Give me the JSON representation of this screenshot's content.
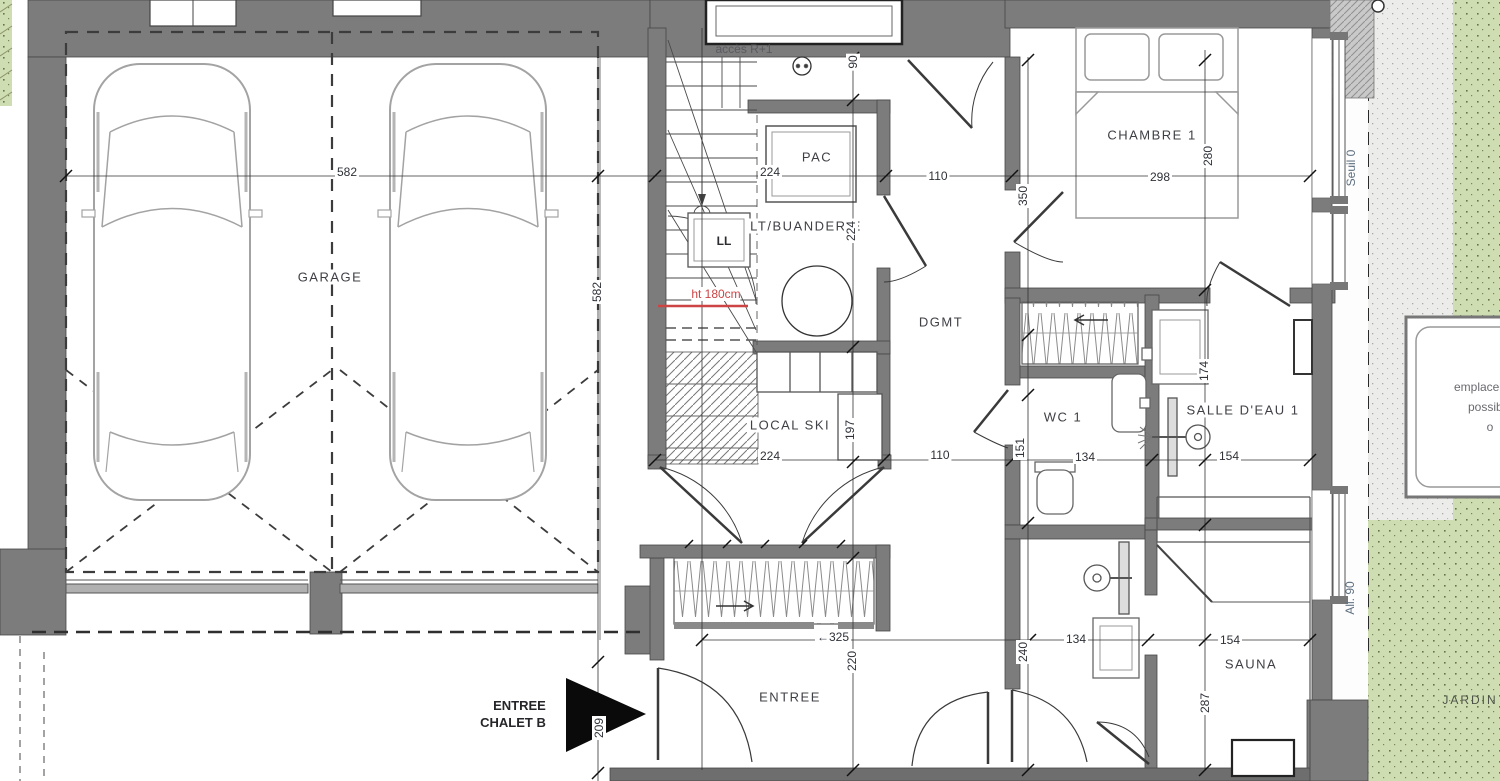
{
  "colors": {
    "wall": "#7c7c7c",
    "wall_dark": "#474747",
    "garden_green": "#cfddb2",
    "terrace_grey": "#ececea",
    "accent_red": "#cc4444",
    "dim_text": "#2e3138",
    "note_blue_grey": "#5f7080"
  },
  "rooms": [
    {
      "id": "garage",
      "label": "GARAGE",
      "x": 330,
      "y": 277
    },
    {
      "id": "pac",
      "label": "PAC",
      "x": 817,
      "y": 157
    },
    {
      "id": "buanderie",
      "label": "LT/BUANDERIE",
      "x": 806,
      "y": 226
    },
    {
      "id": "local-ski",
      "label": "LOCAL SKI",
      "x": 790,
      "y": 425
    },
    {
      "id": "dgmt",
      "label": "DGMT",
      "x": 941,
      "y": 322
    },
    {
      "id": "chambre-1",
      "label": "CHAMBRE 1",
      "x": 1152,
      "y": 135
    },
    {
      "id": "wc-1",
      "label": "WC 1",
      "x": 1063,
      "y": 417
    },
    {
      "id": "salle-deau-1",
      "label": "SALLE D'EAU 1",
      "x": 1243,
      "y": 410
    },
    {
      "id": "sauna",
      "label": "SAUNA",
      "x": 1251,
      "y": 664
    },
    {
      "id": "entree",
      "label": "ENTREE",
      "x": 790,
      "y": 697
    }
  ],
  "dimensions": [
    {
      "v": "582",
      "x": 347,
      "y": 172
    },
    {
      "v": "582",
      "x": 597,
      "y": 292,
      "r": 1
    },
    {
      "v": "224",
      "x": 770,
      "y": 172
    },
    {
      "v": "110",
      "x": 938,
      "y": 176
    },
    {
      "v": "90",
      "x": 853,
      "y": 62,
      "r": 1
    },
    {
      "v": "350",
      "x": 1023,
      "y": 196,
      "r": 1
    },
    {
      "v": "298",
      "x": 1160,
      "y": 177
    },
    {
      "v": "280",
      "x": 1208,
      "y": 156,
      "r": 1
    },
    {
      "v": "224",
      "x": 851,
      "y": 231,
      "r": 1
    },
    {
      "v": "224",
      "x": 770,
      "y": 456
    },
    {
      "v": "197",
      "x": 850,
      "y": 430,
      "r": 1
    },
    {
      "v": "110",
      "x": 940,
      "y": 455
    },
    {
      "v": "151",
      "x": 1020,
      "y": 448,
      "r": 1
    },
    {
      "v": "134",
      "x": 1085,
      "y": 457
    },
    {
      "v": "154",
      "x": 1229,
      "y": 456
    },
    {
      "v": "174",
      "x": 1204,
      "y": 371,
      "r": 1
    },
    {
      "v": "134",
      "x": 1076,
      "y": 639
    },
    {
      "v": "240",
      "x": 1023,
      "y": 652,
      "r": 1
    },
    {
      "v": "154",
      "x": 1230,
      "y": 640
    },
    {
      "v": "287",
      "x": 1205,
      "y": 703,
      "r": 1
    },
    {
      "v": "←325",
      "x": 833,
      "y": 637
    },
    {
      "v": "220",
      "x": 852,
      "y": 661,
      "r": 1
    },
    {
      "v": "209",
      "x": 599,
      "y": 728,
      "r": 1
    }
  ],
  "annotations": {
    "acces": "accès R+1",
    "ll": "LL",
    "ht": "ht 180cm",
    "seuil": "Seuil 0",
    "all90": "All. 90",
    "jardin": "JARDIN",
    "entry_line1": "ENTREE",
    "entry_line2": "CHALET B",
    "box_line1": "emplacement",
    "box_line2": "possible",
    "box_line3": "o"
  }
}
